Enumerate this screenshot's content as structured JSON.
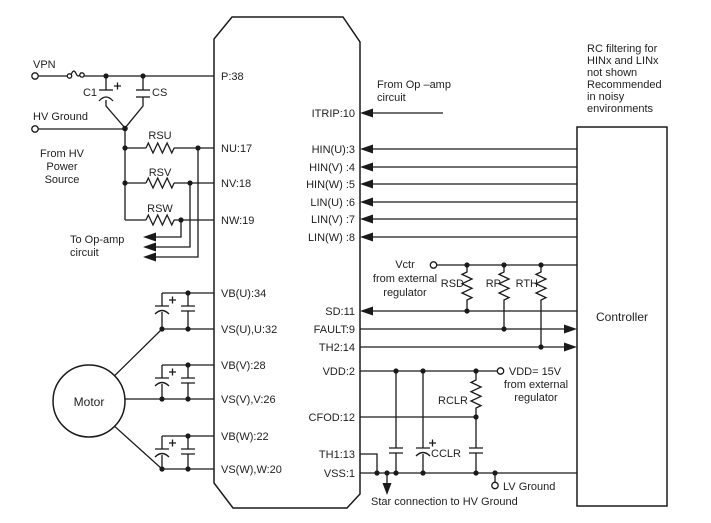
{
  "ic": {
    "pins_left": [
      "P:38",
      "NU:17",
      "NV:18",
      "NW:19",
      "VB(U):34",
      "VS(U),U:32",
      "VB(V):28",
      "VS(V),V:26",
      "VB(W):22",
      "VS(W),W:20"
    ],
    "pins_right": [
      "ITRIP:10",
      "HIN(U):3",
      "HIN(V) :4",
      "HIN(W) :5",
      "LIN(U) :6",
      "LIN(V) :7",
      "LIN(W) :8",
      "SD:11",
      "FAULT:9",
      "TH2:14",
      "VDD:2",
      "CFOD:12",
      "TH1:13",
      "VSS:1"
    ]
  },
  "blocks": {
    "motor": "Motor",
    "controller": "Controller"
  },
  "components": {
    "c1": "C1",
    "cs": "CS",
    "rsu": "RSU",
    "rsv": "RSV",
    "rsw": "RSW",
    "rsd": "RSD",
    "rp": "RP",
    "rth": "RTH",
    "rclr": "RCLR",
    "cclr": "CCLR"
  },
  "terminals": {
    "vpn": "VPN",
    "hv_ground": "HV Ground",
    "lv_ground": "LV Ground",
    "vctr_lines": [
      "Vctr",
      "from external",
      "regulator"
    ],
    "vdd_lines": [
      "VDD= 15V",
      "from external",
      "regulator"
    ]
  },
  "annotations": {
    "from_hv_lines": [
      "From HV",
      "Power",
      "Source"
    ],
    "to_opamp_lines": [
      "To Op-amp",
      "circuit"
    ],
    "from_opamp_lines": [
      "From Op –amp",
      "circuit"
    ],
    "rc_note_lines": [
      "RC filtering for",
      "HINx and LINx",
      "not shown",
      "Recommended",
      "in noisy",
      "environments"
    ],
    "star_note": "Star connection to HV Ground"
  },
  "colors": {
    "line": "#1a1a1a",
    "text": "#1f1f1f",
    "background": "#ffffff"
  }
}
